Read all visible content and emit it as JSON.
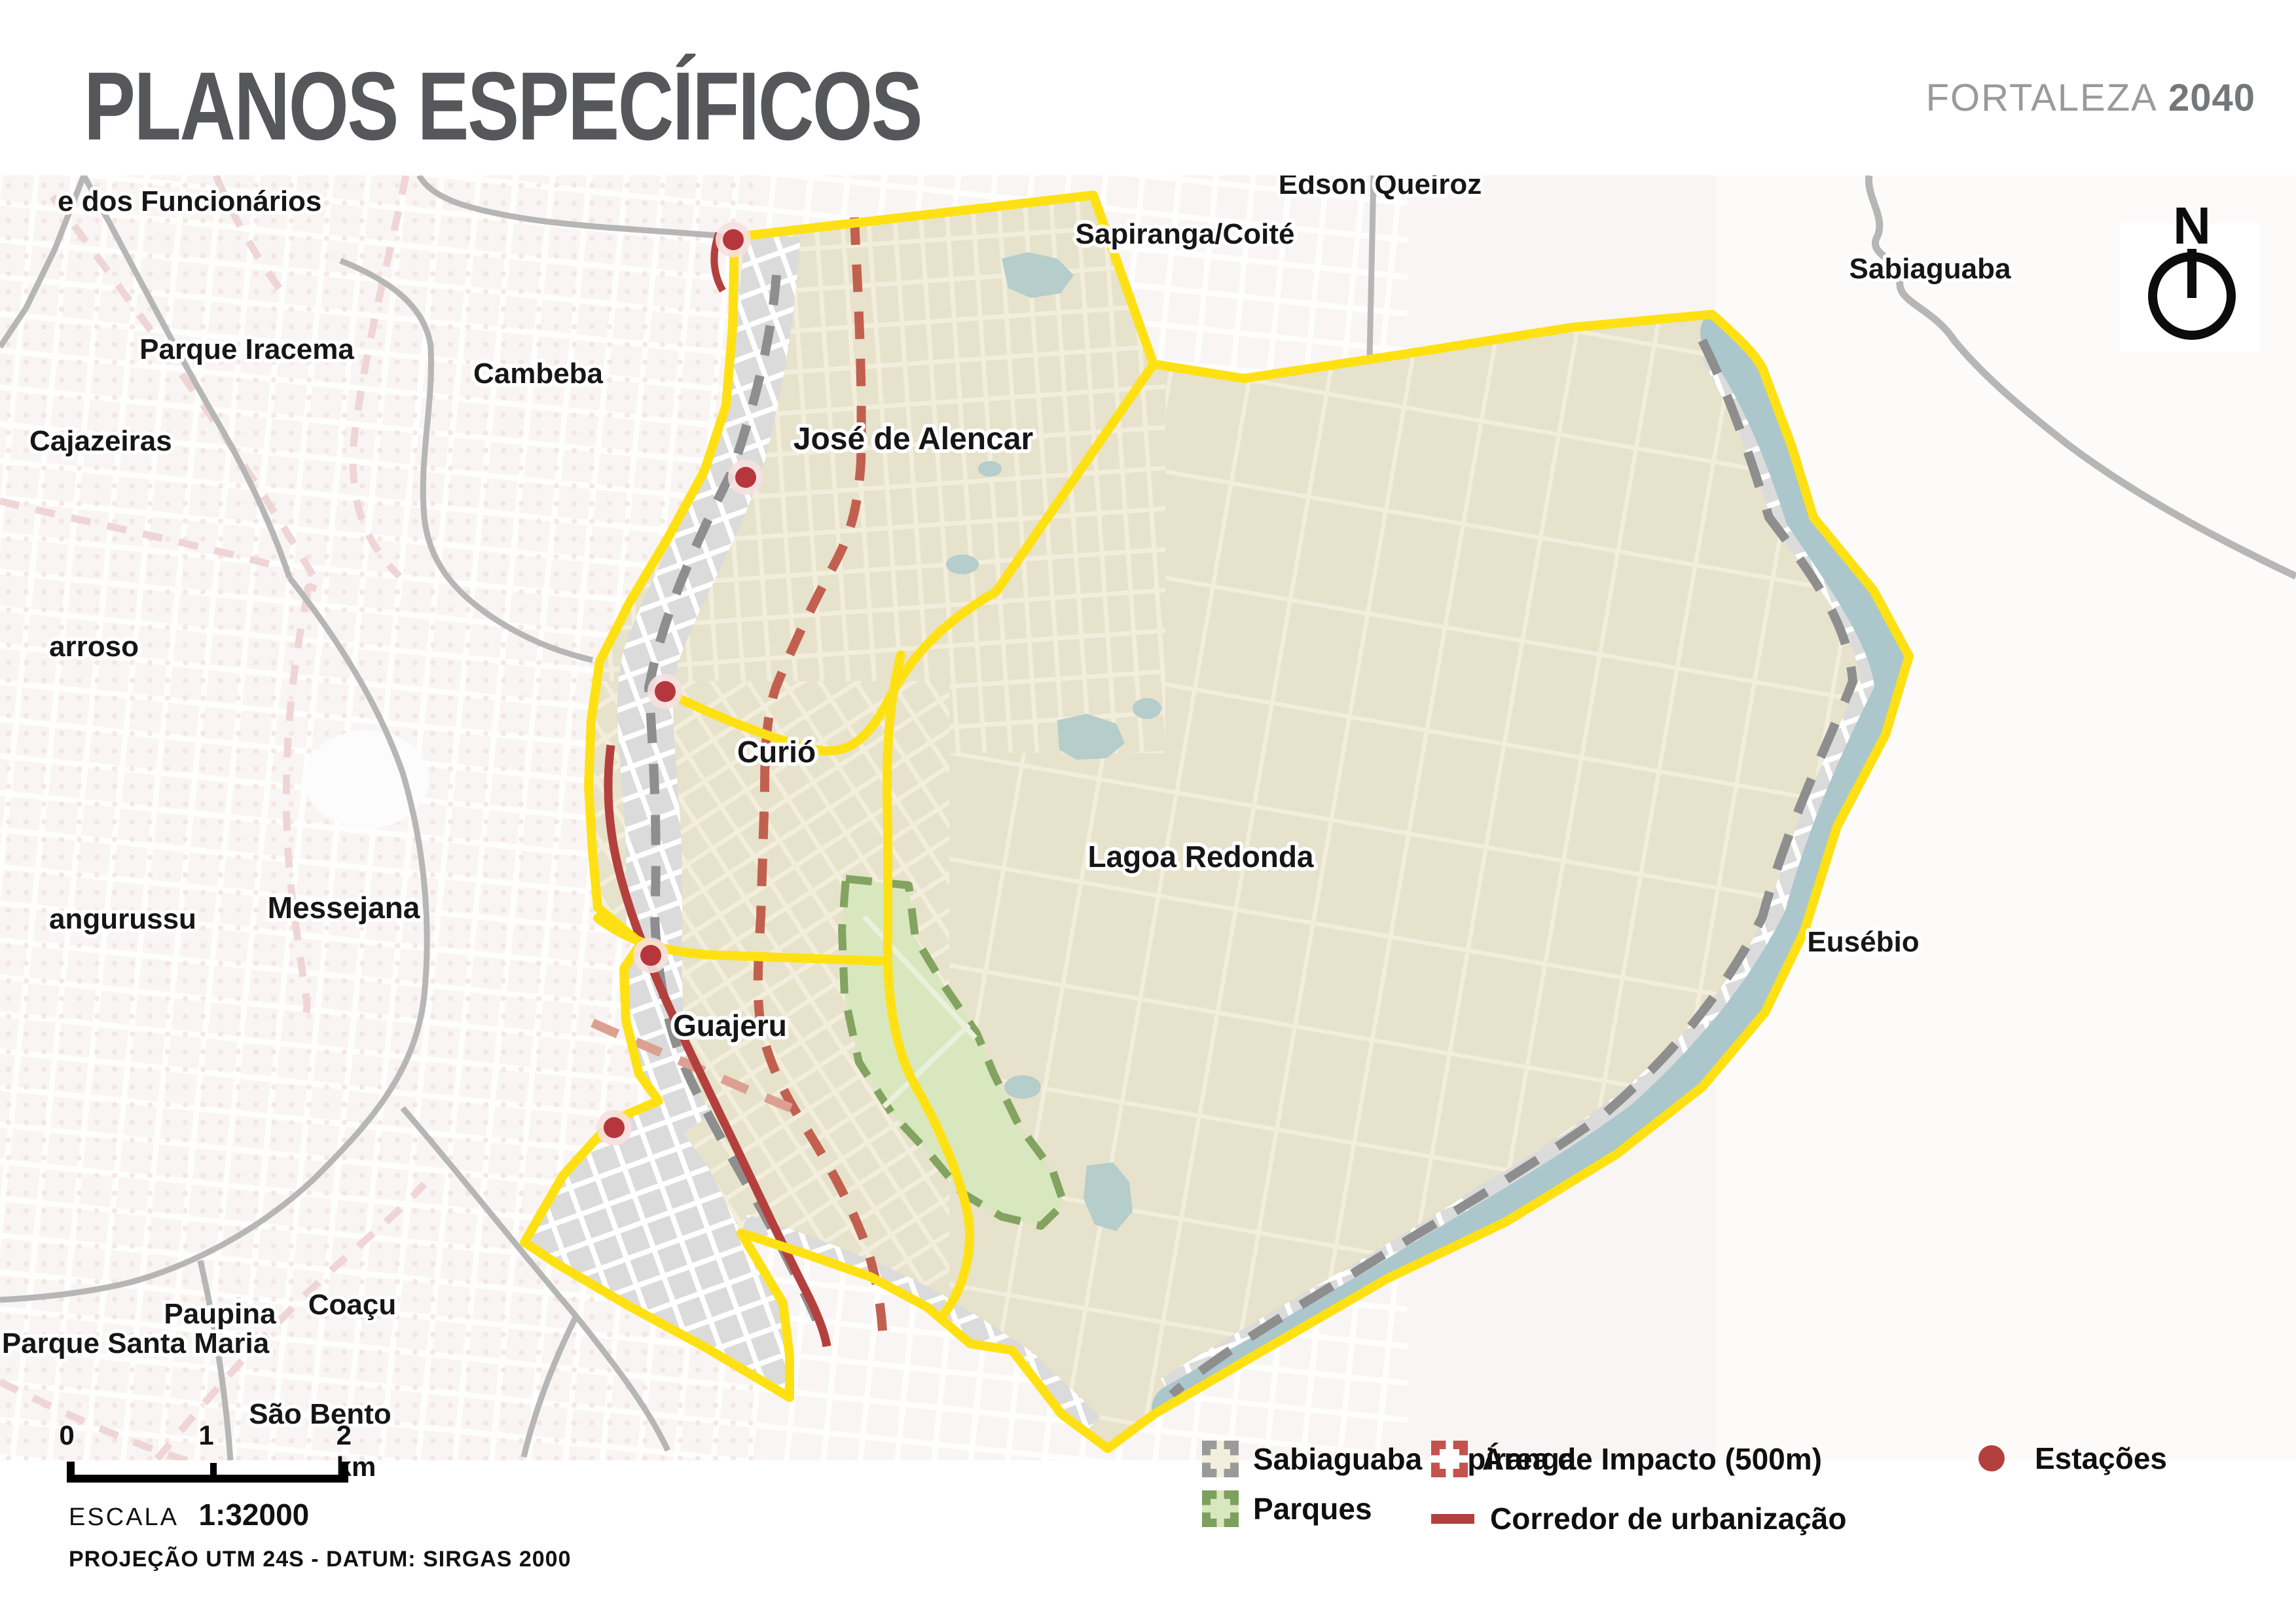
{
  "header": {
    "title": "PLANOS ESPECÍFICOS",
    "brand_light": "FORTALEZA",
    "brand_bold": "2040"
  },
  "compass": {
    "north_letter": "N"
  },
  "map": {
    "labels": {
      "funcionarios": "e dos Funcionários",
      "parque_iracema": "Parque Iracema",
      "cambeba": "Cambeba",
      "cajazeiras": "Cajazeiras",
      "barroso": "arroso",
      "messejana": "Messejana",
      "jangurussu": "angurussu",
      "parque_santa_maria": "Parque Santa Maria",
      "paupina": "Paupina",
      "coacu": "Coaçu",
      "sao_bento": "São Bento",
      "jose_de_alencar": "José de Alencar",
      "curio": "Curió",
      "guajeru": "Guajeru",
      "sapiranga_coite": "Sapiranga/Coité",
      "edson_queiroz": "Edson Queiroz",
      "lagoa_redonda": "Lagoa Redonda",
      "sabiaguaba": "Sabiaguaba",
      "eusebio": "Eusébio"
    }
  },
  "legend": {
    "items": {
      "sabiaguaba_sapiranga": "Sabiaguaba Sapiranga",
      "parques": "Parques",
      "area_impacto": "Área de Impacto (500m)",
      "corredor": "Corredor de urbanização",
      "estacoes": "Estações"
    }
  },
  "scalebar": {
    "tick0": "0",
    "tick1": "1",
    "tick2": "2 km",
    "escala_label": "ESCALA",
    "escala_value": "1:32000",
    "projection": "PROJEÇÃO UTM 24S - DATUM: SIRGAS 2000"
  },
  "colors": {
    "accent_yellow": "#FFE113",
    "plan_fill": "#E6E2CB",
    "park_fill": "#D9E7BF",
    "park_stroke": "#83A361",
    "river_blue": "#ABC7CB",
    "corridor_red": "#B4403E",
    "impact_red": "#C2604F",
    "station_red": "#B5373D",
    "dashed_gray": "#8E8E8E",
    "border_gray": "#B6B6B6"
  }
}
